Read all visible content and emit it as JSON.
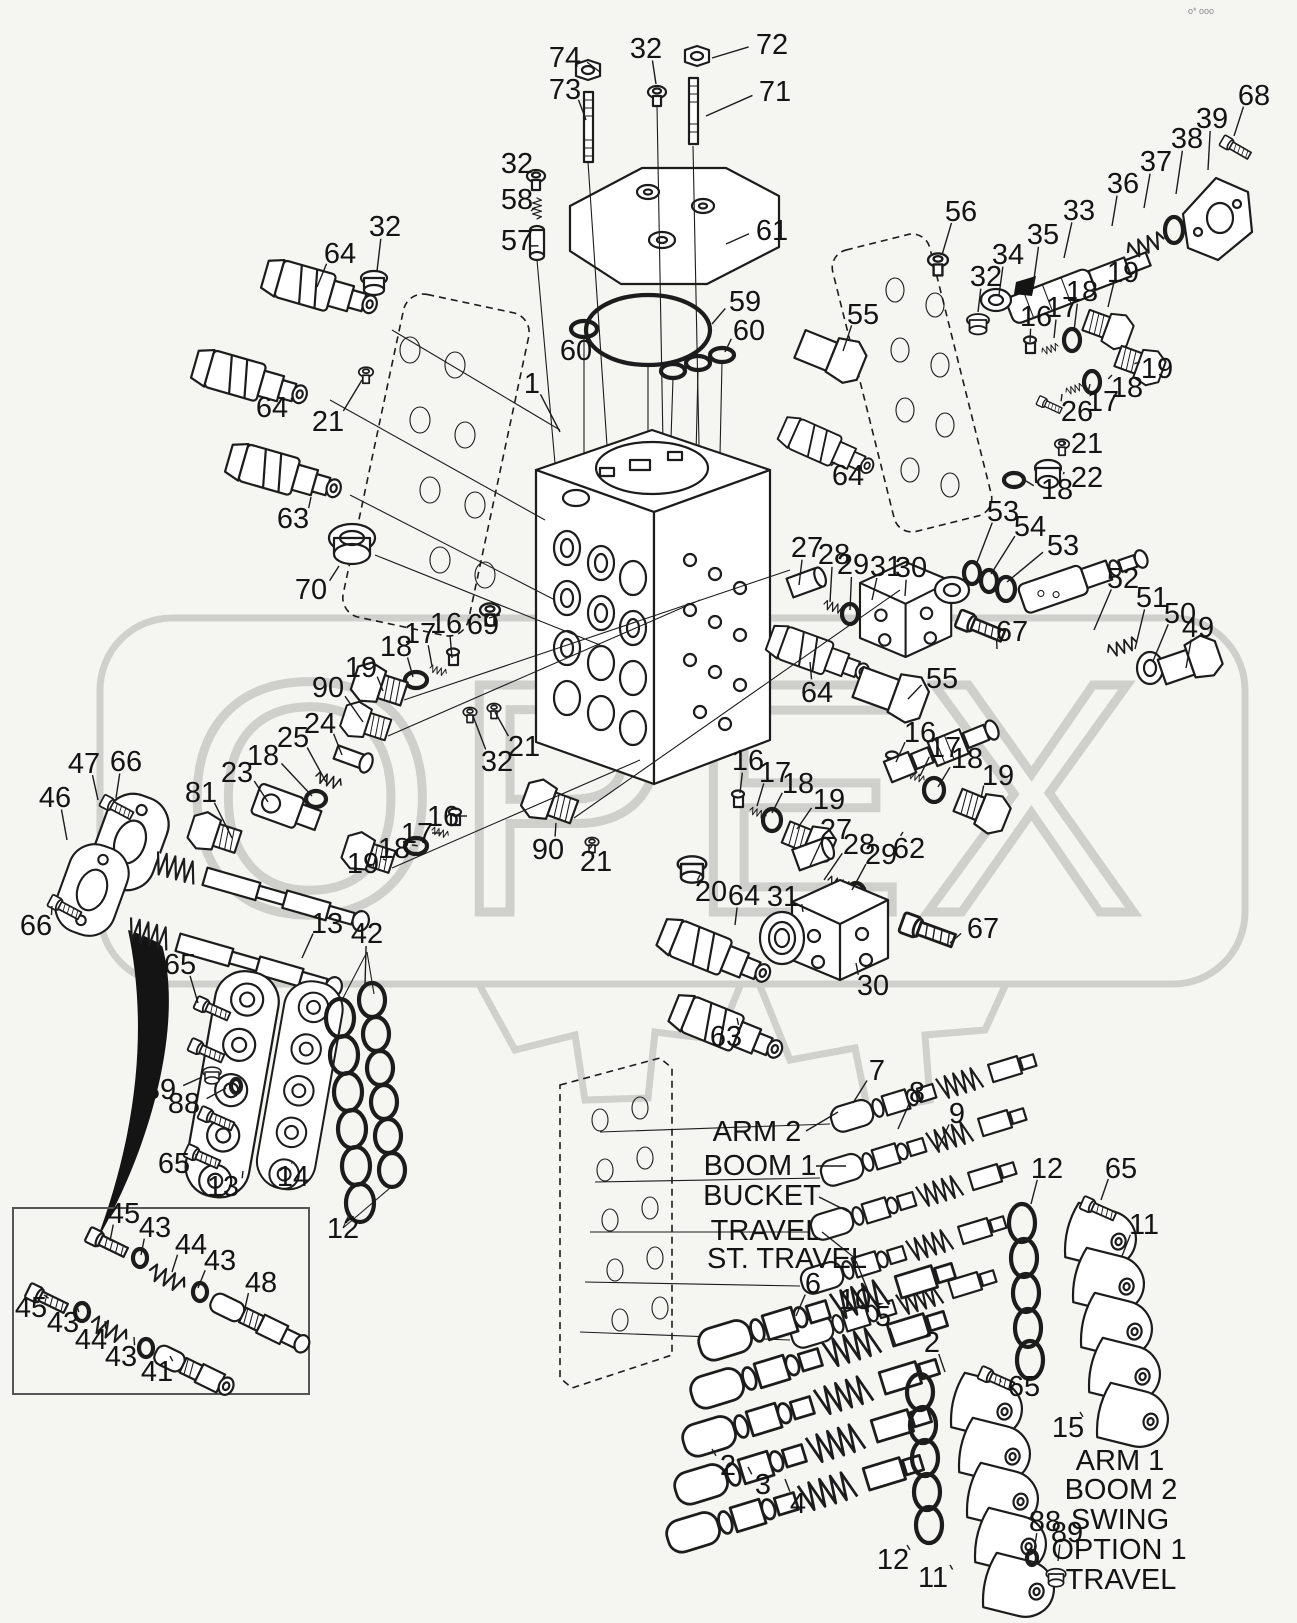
{
  "page": {
    "background": "#f5f5f2",
    "line_color": "#1c1c1c",
    "grey": "#c9c9c6",
    "corner_marks": "o* ooo"
  },
  "watermark": {
    "text": "OPEX"
  },
  "labels": {
    "left": [
      {
        "t": "ARM 2",
        "x": 757,
        "y": 1141,
        "sx": 806,
        "sy": 1131,
        "lx": 838,
        "ly": 1112
      },
      {
        "t": "BOOM 1",
        "x": 760,
        "y": 1175,
        "sx": 816,
        "sy": 1166,
        "lx": 846,
        "ly": 1166
      },
      {
        "t": "BUCKET",
        "x": 762,
        "y": 1205,
        "sx": 819,
        "sy": 1197,
        "lx": 851,
        "ly": 1213
      },
      {
        "t": "TRAVEL",
        "x": 766,
        "y": 1240,
        "sx": 822,
        "sy": 1232,
        "lx": 856,
        "ly": 1259
      },
      {
        "t": "ST. TRAVEL",
        "x": 787,
        "y": 1268,
        "sx": 856,
        "sy": 1261,
        "lx": 870,
        "ly": 1296
      }
    ],
    "right": [
      {
        "t": "ARM 1",
        "x": 1120,
        "y": 1470
      },
      {
        "t": "BOOM 2",
        "x": 1121,
        "y": 1499
      },
      {
        "t": "SWING",
        "x": 1120,
        "y": 1529
      },
      {
        "t": "OPTION 1",
        "x": 1119,
        "y": 1559
      },
      {
        "t": "TRAVEL",
        "x": 1121,
        "y": 1589
      }
    ]
  },
  "callouts": [
    {
      "t": "74",
      "x": 565,
      "y": 67,
      "lx": 600,
      "ly": 72
    },
    {
      "t": "73",
      "x": 565,
      "y": 99,
      "lx": 586,
      "ly": 120
    },
    {
      "t": "32",
      "x": 646,
      "y": 58,
      "lx": 656,
      "ly": 84
    },
    {
      "t": "72",
      "x": 772,
      "y": 54,
      "lx": 712,
      "ly": 58
    },
    {
      "t": "71",
      "x": 775,
      "y": 101,
      "lx": 706,
      "ly": 116
    },
    {
      "t": "32",
      "x": 517,
      "y": 173,
      "lx": 532,
      "ly": 176
    },
    {
      "t": "58",
      "x": 517,
      "y": 209,
      "lx": 531,
      "ly": 211
    },
    {
      "t": "57",
      "x": 517,
      "y": 250,
      "lx": 529,
      "ly": 246
    },
    {
      "t": "61",
      "x": 772,
      "y": 240,
      "lx": 726,
      "ly": 244
    },
    {
      "t": "68",
      "x": 1254,
      "y": 105,
      "lx": 1234,
      "ly": 136
    },
    {
      "t": "39",
      "x": 1212,
      "y": 128,
      "lx": 1208,
      "ly": 170
    },
    {
      "t": "38",
      "x": 1187,
      "y": 148,
      "lx": 1176,
      "ly": 194
    },
    {
      "t": "37",
      "x": 1156,
      "y": 171,
      "lx": 1144,
      "ly": 208
    },
    {
      "t": "36",
      "x": 1123,
      "y": 193,
      "lx": 1112,
      "ly": 226
    },
    {
      "t": "33",
      "x": 1079,
      "y": 220,
      "lx": 1064,
      "ly": 258
    },
    {
      "t": "56",
      "x": 961,
      "y": 221,
      "lx": 942,
      "ly": 255
    },
    {
      "t": "35",
      "x": 1043,
      "y": 244,
      "lx": 1033,
      "ly": 286
    },
    {
      "t": "34",
      "x": 1008,
      "y": 264,
      "lx": 999,
      "ly": 295
    },
    {
      "t": "32",
      "x": 986,
      "y": 286,
      "lx": 978,
      "ly": 312
    },
    {
      "t": "16",
      "x": 1036,
      "y": 326,
      "lx": 1030,
      "ly": 342
    },
    {
      "t": "17",
      "x": 1062,
      "y": 317,
      "lx": 1054,
      "ly": 338
    },
    {
      "t": "18",
      "x": 1082,
      "y": 301,
      "lx": 1074,
      "ly": 331
    },
    {
      "t": "19",
      "x": 1123,
      "y": 282,
      "lx": 1108,
      "ly": 307
    },
    {
      "t": "19",
      "x": 1157,
      "y": 378,
      "lx": 1140,
      "ly": 362
    },
    {
      "t": "18",
      "x": 1127,
      "y": 397,
      "lx": 1112,
      "ly": 375
    },
    {
      "t": "17",
      "x": 1103,
      "y": 411,
      "lx": 1090,
      "ly": 384
    },
    {
      "t": "26",
      "x": 1077,
      "y": 421,
      "lx": 1062,
      "ly": 394
    },
    {
      "t": "21",
      "x": 1087,
      "y": 453,
      "lx": 1066,
      "ly": 443
    },
    {
      "t": "22",
      "x": 1087,
      "y": 487,
      "lx": 1064,
      "ly": 472
    },
    {
      "t": "18",
      "x": 1057,
      "y": 499,
      "lx": 1026,
      "ly": 481
    },
    {
      "t": "55",
      "x": 863,
      "y": 324,
      "lx": 843,
      "ly": 351
    },
    {
      "t": "64",
      "x": 340,
      "y": 263,
      "lx": 317,
      "ly": 287
    },
    {
      "t": "32",
      "x": 385,
      "y": 236,
      "lx": 377,
      "ly": 271
    },
    {
      "t": "64",
      "x": 272,
      "y": 417,
      "lx": 291,
      "ly": 398
    },
    {
      "t": "21",
      "x": 328,
      "y": 431,
      "lx": 362,
      "ly": 380
    },
    {
      "t": "63",
      "x": 293,
      "y": 528,
      "lx": 311,
      "ly": 497
    },
    {
      "t": "70",
      "x": 311,
      "y": 599,
      "lx": 339,
      "ly": 566
    },
    {
      "t": "1",
      "x": 532,
      "y": 393,
      "lx": 560,
      "ly": 432
    },
    {
      "t": "59",
      "x": 745,
      "y": 311,
      "lx": 712,
      "ly": 324
    },
    {
      "t": "60",
      "x": 576,
      "y": 360,
      "lx": 583,
      "ly": 341
    },
    {
      "t": "60",
      "x": 749,
      "y": 340,
      "lx": 725,
      "ly": 352
    },
    {
      "t": "64",
      "x": 848,
      "y": 485,
      "lx": 835,
      "ly": 462
    },
    {
      "t": "53",
      "x": 1003,
      "y": 521,
      "lx": 976,
      "ly": 565
    },
    {
      "t": "54",
      "x": 1030,
      "y": 536,
      "lx": 991,
      "ly": 574
    },
    {
      "t": "53",
      "x": 1063,
      "y": 555,
      "lx": 1007,
      "ly": 582
    },
    {
      "t": "52",
      "x": 1123,
      "y": 588,
      "lx": 1094,
      "ly": 630
    },
    {
      "t": "51",
      "x": 1152,
      "y": 607,
      "lx": 1135,
      "ly": 649
    },
    {
      "t": "50",
      "x": 1180,
      "y": 623,
      "lx": 1153,
      "ly": 661
    },
    {
      "t": "49",
      "x": 1198,
      "y": 637,
      "lx": 1186,
      "ly": 668
    },
    {
      "t": "27",
      "x": 807,
      "y": 557,
      "lx": 799,
      "ly": 585
    },
    {
      "t": "28",
      "x": 834,
      "y": 564,
      "lx": 830,
      "ly": 602
    },
    {
      "t": "29",
      "x": 853,
      "y": 574,
      "lx": 850,
      "ly": 610
    },
    {
      "t": "31",
      "x": 886,
      "y": 576,
      "lx": 872,
      "ly": 600
    },
    {
      "t": "30",
      "x": 911,
      "y": 577,
      "lx": 905,
      "ly": 596
    },
    {
      "t": "67",
      "x": 1012,
      "y": 641,
      "lx": 997,
      "ly": 649
    },
    {
      "t": "64",
      "x": 817,
      "y": 702,
      "lx": 810,
      "ly": 662
    },
    {
      "t": "55",
      "x": 942,
      "y": 688,
      "lx": 908,
      "ly": 699
    },
    {
      "t": "16",
      "x": 920,
      "y": 742,
      "lx": 896,
      "ly": 762
    },
    {
      "t": "17",
      "x": 945,
      "y": 757,
      "lx": 920,
      "ly": 776
    },
    {
      "t": "18",
      "x": 967,
      "y": 768,
      "lx": 938,
      "ly": 787
    },
    {
      "t": "19",
      "x": 998,
      "y": 785,
      "lx": 981,
      "ly": 798
    },
    {
      "t": "16",
      "x": 748,
      "y": 770,
      "lx": 740,
      "ly": 793
    },
    {
      "t": "17",
      "x": 775,
      "y": 782,
      "lx": 757,
      "ly": 806
    },
    {
      "t": "18",
      "x": 798,
      "y": 793,
      "lx": 772,
      "ly": 813
    },
    {
      "t": "19",
      "x": 829,
      "y": 809,
      "lx": 797,
      "ly": 829
    },
    {
      "t": "27",
      "x": 836,
      "y": 839,
      "lx": 810,
      "ly": 866
    },
    {
      "t": "28",
      "x": 859,
      "y": 854,
      "lx": 824,
      "ly": 880
    },
    {
      "t": "29",
      "x": 881,
      "y": 864,
      "lx": 852,
      "ly": 890
    },
    {
      "t": "62",
      "x": 909,
      "y": 858,
      "lx": 903,
      "ly": 832
    },
    {
      "t": "31",
      "x": 783,
      "y": 906,
      "lx": 803,
      "ly": 912
    },
    {
      "t": "30",
      "x": 873,
      "y": 995,
      "lx": 856,
      "ly": 963
    },
    {
      "t": "67",
      "x": 983,
      "y": 938,
      "lx": 950,
      "ly": 943
    },
    {
      "t": "20",
      "x": 711,
      "y": 901,
      "lx": 700,
      "ly": 875
    },
    {
      "t": "64",
      "x": 744,
      "y": 905,
      "lx": 735,
      "ly": 925
    },
    {
      "t": "63",
      "x": 726,
      "y": 1046,
      "lx": 737,
      "ly": 1018
    },
    {
      "t": "69",
      "x": 483,
      "y": 634,
      "lx": 489,
      "ly": 618
    },
    {
      "t": "16",
      "x": 446,
      "y": 633,
      "lx": 452,
      "ly": 658
    },
    {
      "t": "17",
      "x": 420,
      "y": 643,
      "lx": 432,
      "ly": 666
    },
    {
      "t": "18",
      "x": 396,
      "y": 656,
      "lx": 413,
      "ly": 677
    },
    {
      "t": "19",
      "x": 361,
      "y": 677,
      "lx": 383,
      "ly": 691
    },
    {
      "t": "90",
      "x": 328,
      "y": 697,
      "lx": 363,
      "ly": 722
    },
    {
      "t": "24",
      "x": 320,
      "y": 733,
      "lx": 342,
      "ly": 755
    },
    {
      "t": "25",
      "x": 293,
      "y": 747,
      "lx": 326,
      "ly": 782
    },
    {
      "t": "23",
      "x": 237,
      "y": 782,
      "lx": 268,
      "ly": 802
    },
    {
      "t": "18",
      "x": 263,
      "y": 765,
      "lx": 312,
      "ly": 796
    },
    {
      "t": "81",
      "x": 201,
      "y": 802,
      "lx": 232,
      "ly": 838
    },
    {
      "t": "32",
      "x": 497,
      "y": 771,
      "lx": 473,
      "ly": 716
    },
    {
      "t": "21",
      "x": 524,
      "y": 756,
      "lx": 495,
      "ly": 712
    },
    {
      "t": "16",
      "x": 443,
      "y": 826,
      "lx": 453,
      "ly": 816
    },
    {
      "t": "17",
      "x": 417,
      "y": 843,
      "lx": 432,
      "ly": 833
    },
    {
      "t": "18",
      "x": 394,
      "y": 858,
      "lx": 412,
      "ly": 845
    },
    {
      "t": "19",
      "x": 363,
      "y": 873,
      "lx": 383,
      "ly": 859
    },
    {
      "t": "90",
      "x": 548,
      "y": 859,
      "lx": 556,
      "ly": 823
    },
    {
      "t": "21",
      "x": 596,
      "y": 871,
      "lx": 592,
      "ly": 846
    },
    {
      "t": "47",
      "x": 84,
      "y": 773,
      "lx": 98,
      "ly": 800
    },
    {
      "t": "66",
      "x": 126,
      "y": 771,
      "lx": 116,
      "ly": 798
    },
    {
      "t": "46",
      "x": 55,
      "y": 807,
      "lx": 67,
      "ly": 840
    },
    {
      "t": "66",
      "x": 36,
      "y": 935,
      "lx": 52,
      "ly": 906
    },
    {
      "t": "13",
      "x": 327,
      "y": 933,
      "lx": 302,
      "ly": 958
    },
    {
      "t": "42",
      "x": 367,
      "y": 943,
      "lx": 365,
      "ly": 985
    },
    {
      "t": "65",
      "x": 180,
      "y": 974,
      "lx": 198,
      "ly": 1003
    },
    {
      "t": "89",
      "x": 160,
      "y": 1099,
      "lx": 200,
      "ly": 1078
    },
    {
      "t": "88",
      "x": 184,
      "y": 1113,
      "lx": 226,
      "ly": 1088
    },
    {
      "t": "65",
      "x": 174,
      "y": 1173,
      "lx": 196,
      "ly": 1154
    },
    {
      "t": "13",
      "x": 223,
      "y": 1196,
      "lx": 243,
      "ly": 1171
    },
    {
      "t": "14",
      "x": 293,
      "y": 1186,
      "lx": 292,
      "ly": 1163
    },
    {
      "t": "12",
      "x": 343,
      "y": 1238,
      "lx": 346,
      "ly": 1222
    },
    {
      "t": "45",
      "x": 124,
      "y": 1223,
      "lx": 110,
      "ly": 1241
    },
    {
      "t": "43",
      "x": 155,
      "y": 1237,
      "lx": 141,
      "ly": 1255
    },
    {
      "t": "44",
      "x": 191,
      "y": 1254,
      "lx": 172,
      "ly": 1272
    },
    {
      "t": "43",
      "x": 220,
      "y": 1270,
      "lx": 198,
      "ly": 1288
    },
    {
      "t": "48",
      "x": 261,
      "y": 1292,
      "lx": 245,
      "ly": 1308
    },
    {
      "t": "45",
      "x": 31,
      "y": 1317,
      "lx": 44,
      "ly": 1295
    },
    {
      "t": "43",
      "x": 63,
      "y": 1332,
      "lx": 77,
      "ly": 1306
    },
    {
      "t": "44",
      "x": 91,
      "y": 1349,
      "lx": 105,
      "ly": 1321
    },
    {
      "t": "43",
      "x": 121,
      "y": 1366,
      "lx": 134,
      "ly": 1337
    },
    {
      "t": "41",
      "x": 157,
      "y": 1381,
      "lx": 170,
      "ly": 1356
    },
    {
      "t": "7",
      "x": 877,
      "y": 1080,
      "lx": 853,
      "ly": 1103
    },
    {
      "t": "8",
      "x": 917,
      "y": 1102,
      "lx": 898,
      "ly": 1129
    },
    {
      "t": "9",
      "x": 957,
      "y": 1123,
      "lx": 938,
      "ly": 1149
    },
    {
      "t": "12",
      "x": 1047,
      "y": 1178,
      "lx": 1031,
      "ly": 1204
    },
    {
      "t": "65",
      "x": 1121,
      "y": 1178,
      "lx": 1101,
      "ly": 1200
    },
    {
      "t": "11",
      "x": 1144,
      "y": 1234,
      "lx": 1122,
      "ly": 1256
    },
    {
      "t": "6",
      "x": 813,
      "y": 1293,
      "lx": 796,
      "ly": 1316
    },
    {
      "t": "10",
      "x": 855,
      "y": 1309,
      "lx": 861,
      "ly": 1289
    },
    {
      "t": "5",
      "x": 883,
      "y": 1326,
      "lx": 896,
      "ly": 1346
    },
    {
      "t": "2",
      "x": 932,
      "y": 1352,
      "lx": 945,
      "ly": 1372
    },
    {
      "t": "2",
      "x": 728,
      "y": 1475,
      "lx": 712,
      "ly": 1449
    },
    {
      "t": "3",
      "x": 763,
      "y": 1494,
      "lx": 748,
      "ly": 1467
    },
    {
      "t": "4",
      "x": 798,
      "y": 1513,
      "lx": 785,
      "ly": 1479
    },
    {
      "t": "12",
      "x": 893,
      "y": 1569,
      "lx": 907,
      "ly": 1545
    },
    {
      "t": "11",
      "x": 933,
      "y": 1587,
      "lx": 950,
      "ly": 1565
    },
    {
      "t": "65",
      "x": 1024,
      "y": 1396,
      "lx": 1000,
      "ly": 1379
    },
    {
      "t": "15",
      "x": 1068,
      "y": 1437,
      "lx": 1080,
      "ly": 1412
    },
    {
      "t": "88",
      "x": 1045,
      "y": 1531,
      "lx": 1034,
      "ly": 1551
    },
    {
      "t": "89",
      "x": 1067,
      "y": 1542,
      "lx": 1058,
      "ly": 1561
    }
  ]
}
